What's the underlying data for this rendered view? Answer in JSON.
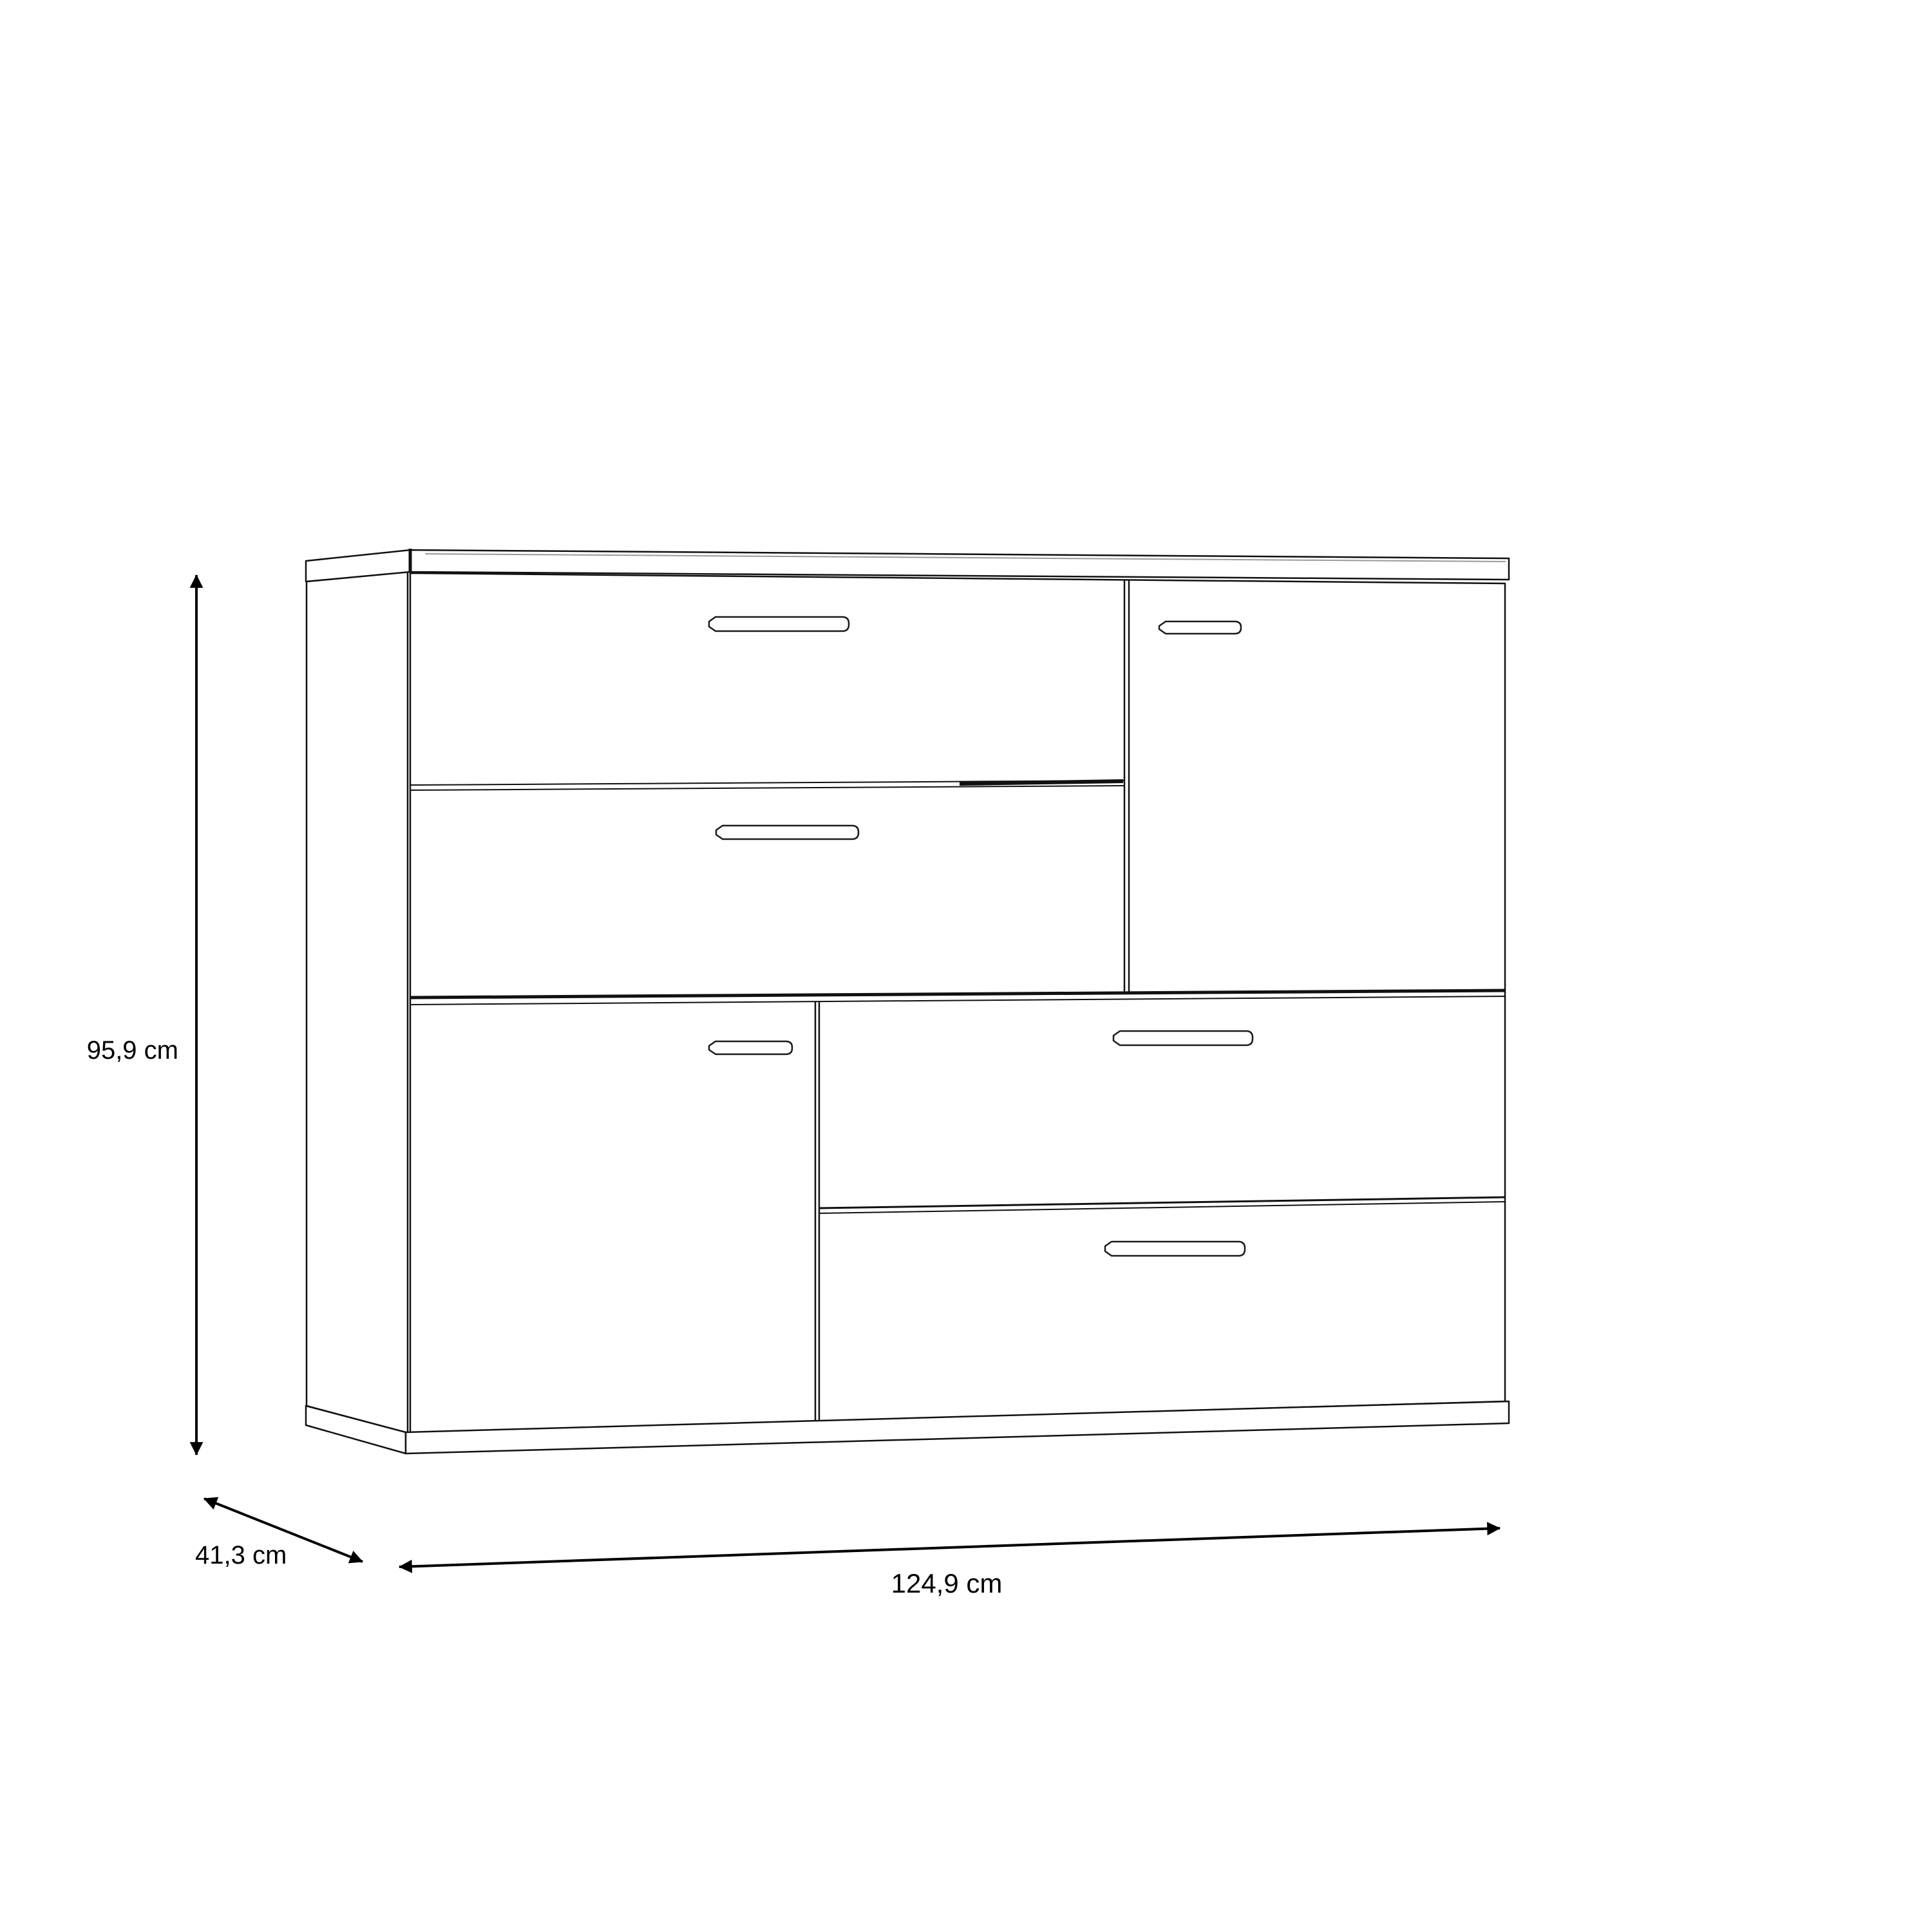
{
  "page": {
    "background": "#ffffff",
    "line_color": "#000000"
  },
  "diagram": {
    "kind": "furniture dimension drawing",
    "furniture": {
      "type": "sideboard",
      "front_layout": {
        "top_left": [
          "drawer",
          "drawer"
        ],
        "top_right": [
          "door"
        ],
        "bottom_left": [
          "door"
        ],
        "bottom_right": [
          "drawer",
          "drawer"
        ]
      }
    },
    "dimensions": {
      "height": "95,9 cm",
      "depth": "41,3 cm",
      "width": "124,9 cm"
    }
  }
}
